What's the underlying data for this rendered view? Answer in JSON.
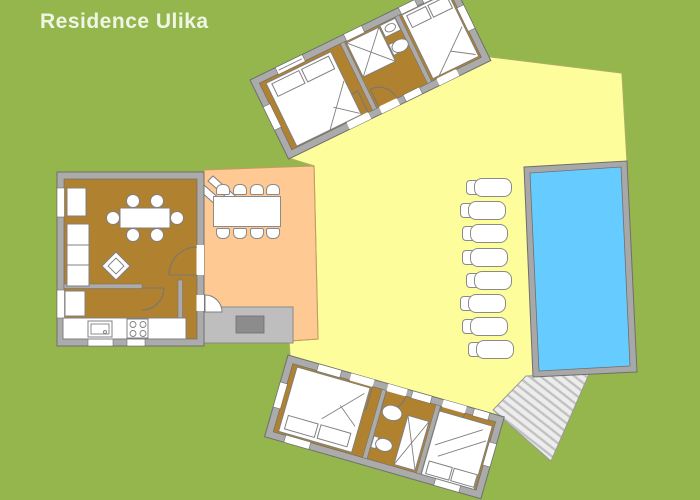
{
  "title": "Residence Ulika",
  "colors": {
    "grass": "#94B64D",
    "sun_terrace": "#FDFD9B",
    "dining_terrace": "#FEC992",
    "floor": "#B0812F",
    "wall": "#ABABAB",
    "wall_outline": "#6F6F6F",
    "pool_water": "#66CCFF",
    "pool_rim": "#A8A8A8",
    "platform": "#BEBEBE",
    "doormat": "#8C8C8C",
    "furniture": "#FFFFFF",
    "furniture_outline": "#808080",
    "deck_base": "#EDEDED",
    "deck_stripe": "#C2C2C2",
    "title_text": "#F0F6E6"
  },
  "site": {
    "pool": {
      "name": "swimming-pool"
    },
    "sun_loungers": {
      "count": 8
    },
    "outdoor_dining_table": {
      "seats": 8
    },
    "terraces": [
      {
        "name": "sun-terrace"
      },
      {
        "name": "dining-terrace"
      }
    ],
    "buildings": [
      {
        "name": "north-bedroom-wing",
        "rooms": [
          "bedroom",
          "bathroom",
          "bedroom"
        ]
      },
      {
        "name": "main-house",
        "rooms": [
          "living-dining-room",
          "kitchen",
          "hall"
        ],
        "dining_table_seats": 6
      },
      {
        "name": "south-bedroom-wing",
        "rooms": [
          "bedroom",
          "bathroom",
          "bedroom"
        ]
      }
    ]
  }
}
